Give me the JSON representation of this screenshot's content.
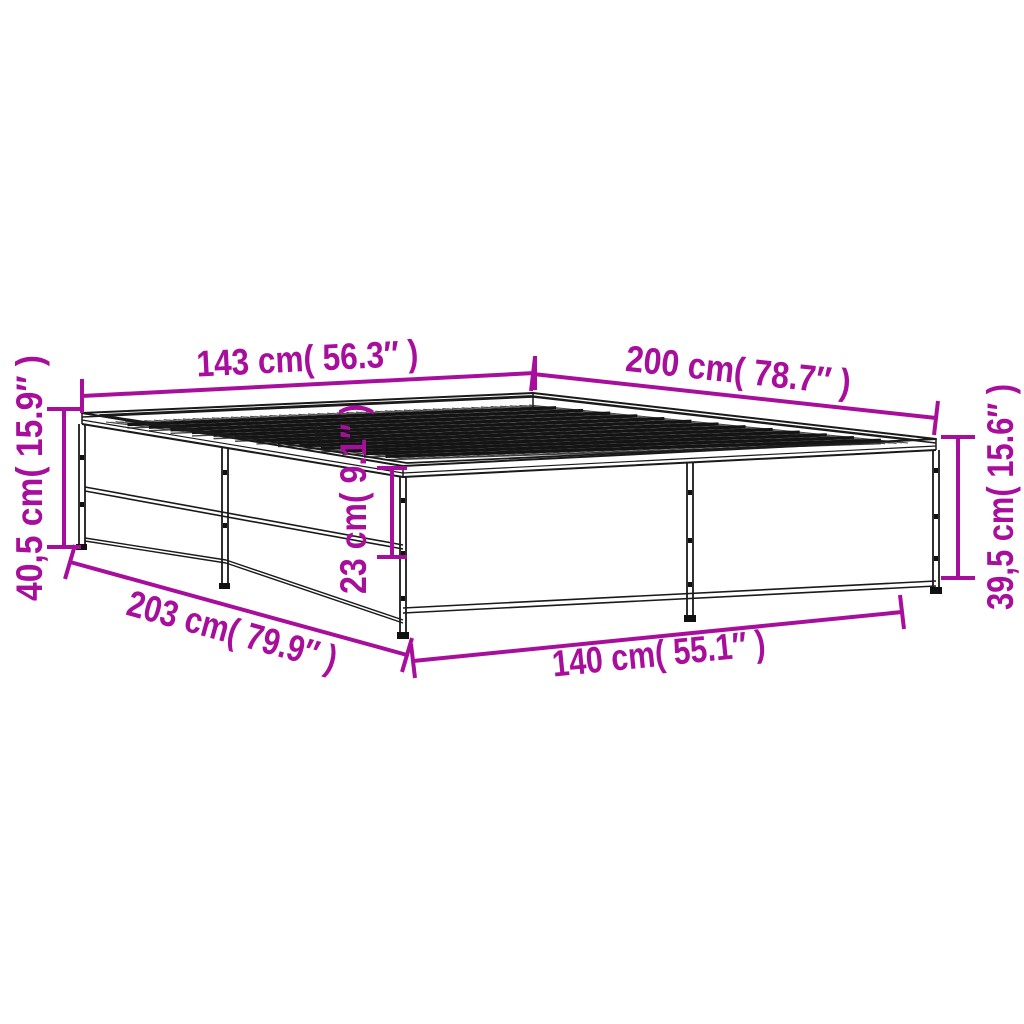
{
  "diagram": {
    "name": "bed-frame-dimension-diagram",
    "background_color": "#ffffff",
    "drawing_line_color": "#1a1a1a",
    "accent_color": "#A80E9C",
    "object": "metal bed frame with slatted top, isometric line drawing",
    "dimensions": {
      "top_width": {
        "label": "143 cm( 56.3″ )",
        "cm": "143",
        "inches": "56.3",
        "position": "top-left edge of frame"
      },
      "top_length": {
        "label": "200 cm( 78.7″ )",
        "cm": "200",
        "inches": "78.7",
        "position": "top-right edge of frame"
      },
      "left_height": {
        "label": "40,5 cm( 15.9″ )",
        "cm": "40,5",
        "inches": "15.9",
        "position": "left side overall height"
      },
      "right_height": {
        "label": "39,5 cm( 15.6″ )",
        "cm": "39,5",
        "inches": "15.6",
        "position": "right side overall height"
      },
      "rail_height": {
        "label": "23 cm( 9.1″ )",
        "cm": "23",
        "inches": "9.1",
        "position": "front rail depth"
      },
      "floor_length": {
        "label": "203 cm( 79.9″ )",
        "cm": "203",
        "inches": "79.9",
        "position": "bottom-left floor edge"
      },
      "floor_width": {
        "label": "140 cm( 55.1″ )",
        "cm": "140",
        "inches": "55.1",
        "position": "bottom-front floor edge"
      }
    }
  }
}
